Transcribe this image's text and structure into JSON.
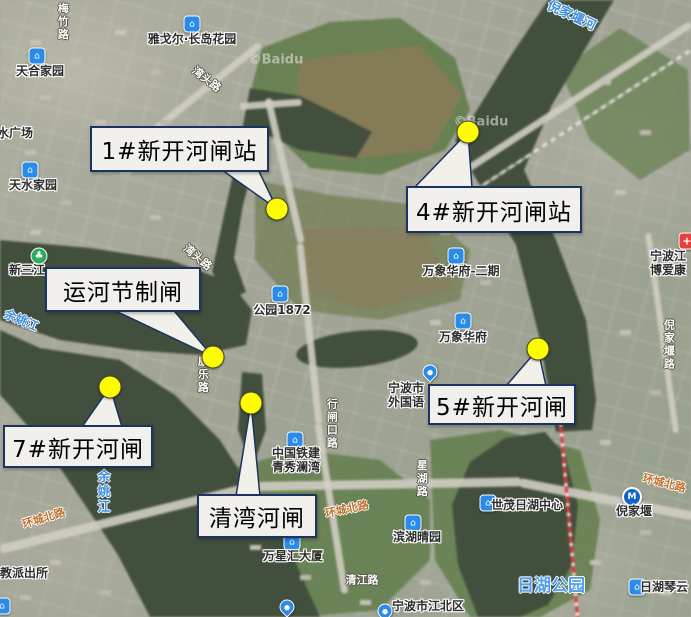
{
  "watermarks": [
    {
      "name": "baidu-watermark-1",
      "text": "©Baidu",
      "x": 276,
      "y": 60
    },
    {
      "name": "baidu-watermark-2",
      "text": "©Baidu",
      "x": 481,
      "y": 122
    }
  ],
  "callouts": [
    {
      "name": "gate1",
      "label": "1#新开河闸站",
      "box": {
        "x": 90,
        "y": 126,
        "w": 175,
        "h": 42
      },
      "dot": {
        "x": 277,
        "y": 209
      },
      "base": [
        [
          215,
          165
        ],
        [
          256,
          165
        ]
      ]
    },
    {
      "name": "gate4",
      "label": "4#新开河闸站",
      "box": {
        "x": 406,
        "y": 186,
        "w": 172,
        "h": 43
      },
      "dot": {
        "x": 468,
        "y": 132
      },
      "base": [
        [
          414,
          188
        ],
        [
          472,
          188
        ]
      ]
    },
    {
      "name": "canal-control-gate",
      "label": "运河节制闸",
      "box": {
        "x": 45,
        "y": 267,
        "w": 152,
        "h": 41
      },
      "dot": {
        "x": 213,
        "y": 357
      },
      "base": [
        [
          105,
          306
        ],
        [
          170,
          306
        ]
      ]
    },
    {
      "name": "gate7",
      "label": "7#新开河闸",
      "box": {
        "x": 3,
        "y": 425,
        "w": 146,
        "h": 39
      },
      "dot": {
        "x": 110,
        "y": 387
      },
      "base": [
        [
          82,
          427
        ],
        [
          122,
          427
        ]
      ]
    },
    {
      "name": "qingwan-gate",
      "label": "清湾河闸",
      "box": {
        "x": 197,
        "y": 494,
        "w": 116,
        "h": 40
      },
      "dot": {
        "x": 251,
        "y": 403
      },
      "base": [
        [
          236,
          496
        ],
        [
          260,
          496
        ]
      ]
    },
    {
      "name": "gate5",
      "label": "5#新开河闸",
      "box": {
        "x": 428,
        "y": 384,
        "w": 144,
        "h": 37
      },
      "dot": {
        "x": 538,
        "y": 349
      },
      "base": [
        [
          506,
          386
        ],
        [
          546,
          386
        ]
      ]
    }
  ],
  "pois": [
    {
      "name": "poi-yageer-changdao-garden",
      "icon": "building",
      "ix": 192,
      "iy": 24,
      "tx": 192,
      "ty": 40,
      "lines": [
        "雅戈尔·长岛花园"
      ]
    },
    {
      "name": "poi-tianhe-jiayuan",
      "icon": "building",
      "ix": 37,
      "iy": 56,
      "tx": 40,
      "ty": 72,
      "lines": [
        "天合家园"
      ]
    },
    {
      "name": "poi-tianshui-guangchang",
      "icon": "none",
      "tx": 9,
      "ty": 134,
      "lines": [
        "天水广场"
      ]
    },
    {
      "name": "poi-tianshui-jiayuan",
      "icon": "building",
      "ix": 30,
      "iy": 170,
      "tx": 33,
      "ty": 186,
      "lines": [
        "天水家园"
      ]
    },
    {
      "name": "poi-xinsanjiang",
      "icon": "park",
      "ix": 39,
      "iy": 256,
      "tx": 27,
      "ty": 271,
      "lines": [
        "新三江"
      ]
    },
    {
      "name": "poi-gongyuan-1872",
      "icon": "building",
      "ix": 280,
      "iy": 294,
      "tx": 282,
      "ty": 311,
      "lines": [
        "公园1872"
      ]
    },
    {
      "name": "poi-wanxiang-huafu-phase2",
      "icon": "building",
      "ix": 456,
      "iy": 256,
      "tx": 461,
      "ty": 272,
      "lines": [
        "万象华府-二期"
      ]
    },
    {
      "name": "poi-wanxiang-huafu",
      "icon": "building",
      "ix": 463,
      "iy": 321,
      "tx": 463,
      "ty": 338,
      "lines": [
        "万象华府"
      ]
    },
    {
      "name": "poi-ningbo-foreign-language-school",
      "icon": "pin",
      "ix": 430,
      "iy": 372,
      "tx": 406,
      "ty": 396,
      "lines": [
        "宁波市",
        "外国语"
      ]
    },
    {
      "name": "poi-zhongguo-tiejian-qingxiu-lanwan",
      "icon": "building",
      "ix": 295,
      "iy": 440,
      "tx": 296,
      "ty": 461,
      "lines": [
        "中国铁建",
        "青秀澜湾"
      ]
    },
    {
      "name": "poi-binhu-qingyuan",
      "icon": "building",
      "ix": 413,
      "iy": 523,
      "tx": 417,
      "ty": 538,
      "lines": [
        "滨湖晴园"
      ]
    },
    {
      "name": "poi-wanxinghui-tower",
      "icon": "building",
      "ix": 292,
      "iy": 542,
      "tx": 293,
      "ty": 557,
      "lines": [
        "万星汇大厦"
      ]
    },
    {
      "name": "poi-shimao-rihu-center",
      "icon": "building",
      "ix": 488,
      "iy": 503,
      "tx": 527,
      "ty": 506,
      "lines": [
        "世茂日湖中心"
      ]
    },
    {
      "name": "poi-nijiayan-metro-station",
      "icon": "metro",
      "ix": 632,
      "iy": 497,
      "tx": 634,
      "ty": 512,
      "lines": [
        "倪家堰"
      ]
    },
    {
      "name": "poi-rihu-qinyun",
      "icon": "building",
      "ix": 637,
      "iy": 587,
      "tx": 664,
      "ty": 588,
      "lines": [
        "日湖琴云"
      ]
    },
    {
      "name": "poi-ningbo-jiangbei-district",
      "icon": "pin",
      "ix": 385,
      "iy": 611,
      "tx": 428,
      "ty": 607,
      "lines": [
        "宁波市江北区"
      ]
    },
    {
      "name": "poi-boai-hospital",
      "icon": "hospital",
      "ix": 687,
      "iy": 241,
      "tx": 668,
      "ty": 264,
      "lines": [
        "宁波江",
        "博爱康"
      ]
    },
    {
      "name": "poi-pin-south",
      "icon": "pin",
      "ix": 287,
      "iy": 607,
      "lines": []
    },
    {
      "name": "poi-corner-southwest",
      "icon": "building",
      "ix": 2,
      "iy": 606,
      "lines": []
    }
  ],
  "road_labels": [
    {
      "name": "road-huanchengbeilu-left",
      "text": "环城北路",
      "x": 44,
      "y": 519,
      "rot": -17,
      "cls": "orange"
    },
    {
      "name": "road-huanchengbeilu-mid",
      "text": "环城北路",
      "x": 347,
      "y": 510,
      "rot": -12,
      "cls": "orange"
    },
    {
      "name": "road-huanchengbeilu-right",
      "text": "环城北路",
      "x": 664,
      "y": 484,
      "rot": 14,
      "cls": "orange"
    },
    {
      "name": "road-meizhu",
      "text": "梅竹路",
      "x": 62,
      "y": 22,
      "vert": true,
      "cls": "halo-white"
    },
    {
      "name": "road-wantou-north",
      "text": "湾头路",
      "x": 206,
      "y": 80,
      "rot": 38,
      "cls": "halo-white"
    },
    {
      "name": "road-wantou-mid",
      "text": "湾头路",
      "x": 197,
      "y": 258,
      "rot": 40,
      "cls": "halo-white"
    },
    {
      "name": "road-kangle",
      "text": "康乐路",
      "x": 202,
      "y": 375,
      "vert": true,
      "cls": "halo-white"
    },
    {
      "name": "road-xingzhakou",
      "text": "行闸口路",
      "x": 331,
      "y": 424,
      "vert": true,
      "cls": "halo-white"
    },
    {
      "name": "road-xinghu",
      "text": "星湖路",
      "x": 421,
      "y": 479,
      "vert": true,
      "cls": "halo-white"
    },
    {
      "name": "road-nijiayan",
      "text": "倪家堰路",
      "x": 668,
      "y": 345,
      "vert": true,
      "cls": "halo-white"
    },
    {
      "name": "road-qingjiang",
      "text": "清江路",
      "x": 362,
      "y": 581,
      "rot": 0,
      "cls": "halo-white"
    },
    {
      "name": "poi-wenjiao-police-station",
      "text": "文教派出所",
      "x": 18,
      "y": 574,
      "rot": 0,
      "cls": "halo-dark"
    }
  ],
  "water_labels": [
    {
      "name": "river-nijiayan-he",
      "text": "倪家堰河",
      "x": 571,
      "y": 17,
      "rot": 25,
      "size": 13,
      "cls": "blue"
    },
    {
      "name": "river-yuyaojiang-west",
      "text": "余姚江",
      "x": 21,
      "y": 321,
      "rot": 23,
      "size": 12,
      "cls": "blue"
    },
    {
      "name": "river-yuyaojiang-south",
      "text": "余姚江",
      "x": 101,
      "y": 492,
      "vert": true,
      "size": 13,
      "cls": "blue"
    },
    {
      "name": "park-rihu-gongyuan",
      "text": "日湖公园",
      "x": 551,
      "y": 587,
      "rot": 0,
      "size": 17,
      "cls": "park-lbl"
    }
  ],
  "icon_glyphs": {
    "building": "⌂",
    "pin": "●",
    "metro": "M",
    "park": "♣",
    "hospital": "+"
  }
}
